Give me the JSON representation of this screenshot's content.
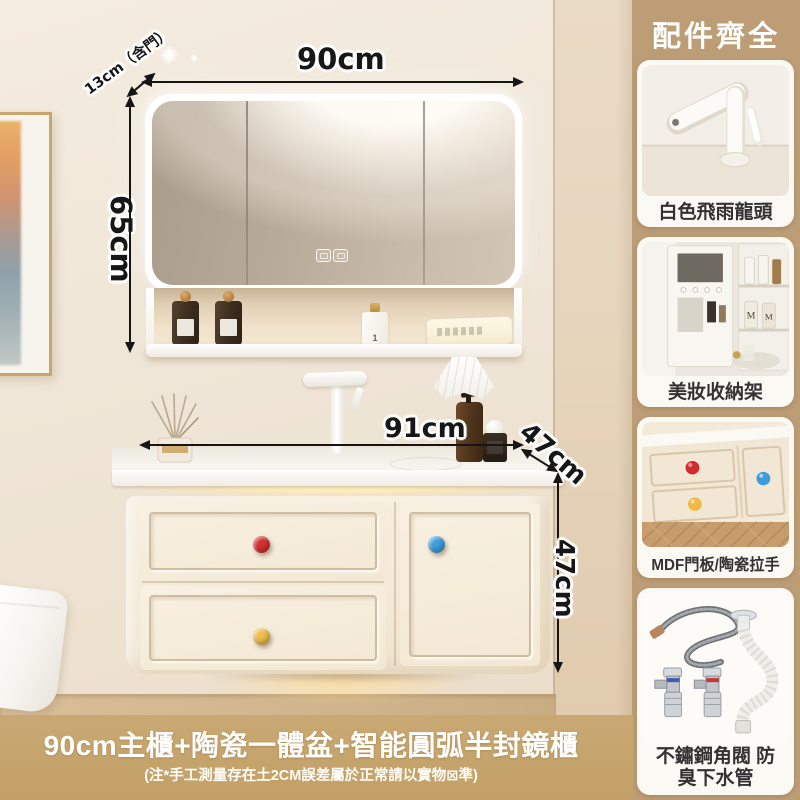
{
  "photo": {
    "dimensions": {
      "mirror_width": "90cm",
      "mirror_depth": "13cm（含門）",
      "mirror_height": "65cm",
      "counter_width": "91cm",
      "counter_depth": "47cm",
      "cabinet_height": "47cm"
    }
  },
  "sidebar": {
    "title": "配件齊全",
    "items": [
      {
        "label": "白色飛雨龍頭",
        "icon": "white-faucet-photo"
      },
      {
        "label": "美妝收納架",
        "icon": "makeup-storage-rack-photo"
      },
      {
        "label": "MDF門板/陶瓷拉手",
        "icon": "mdf-door-ceramic-knobs-photo"
      },
      {
        "label": "不鏽鋼角閥 防\n臭下水管",
        "icon": "stainless-valve-drain-pipe-photo"
      }
    ]
  },
  "banner": {
    "title": "90cm主櫃+陶瓷一體盆+智能圓弧半封鏡櫃",
    "note": "(注*手工測量存在土2CM誤差屬於正常請以實物⊠準)"
  },
  "colors": {
    "sidebar_bg": "#bc9d76",
    "banner_bg": "#c5a36c",
    "knob_red": "#d22f2f",
    "knob_yellow": "#edbc4b",
    "knob_blue": "#3f9cda",
    "led_glow": "#ffeebc",
    "dimension_text": "#171717"
  }
}
